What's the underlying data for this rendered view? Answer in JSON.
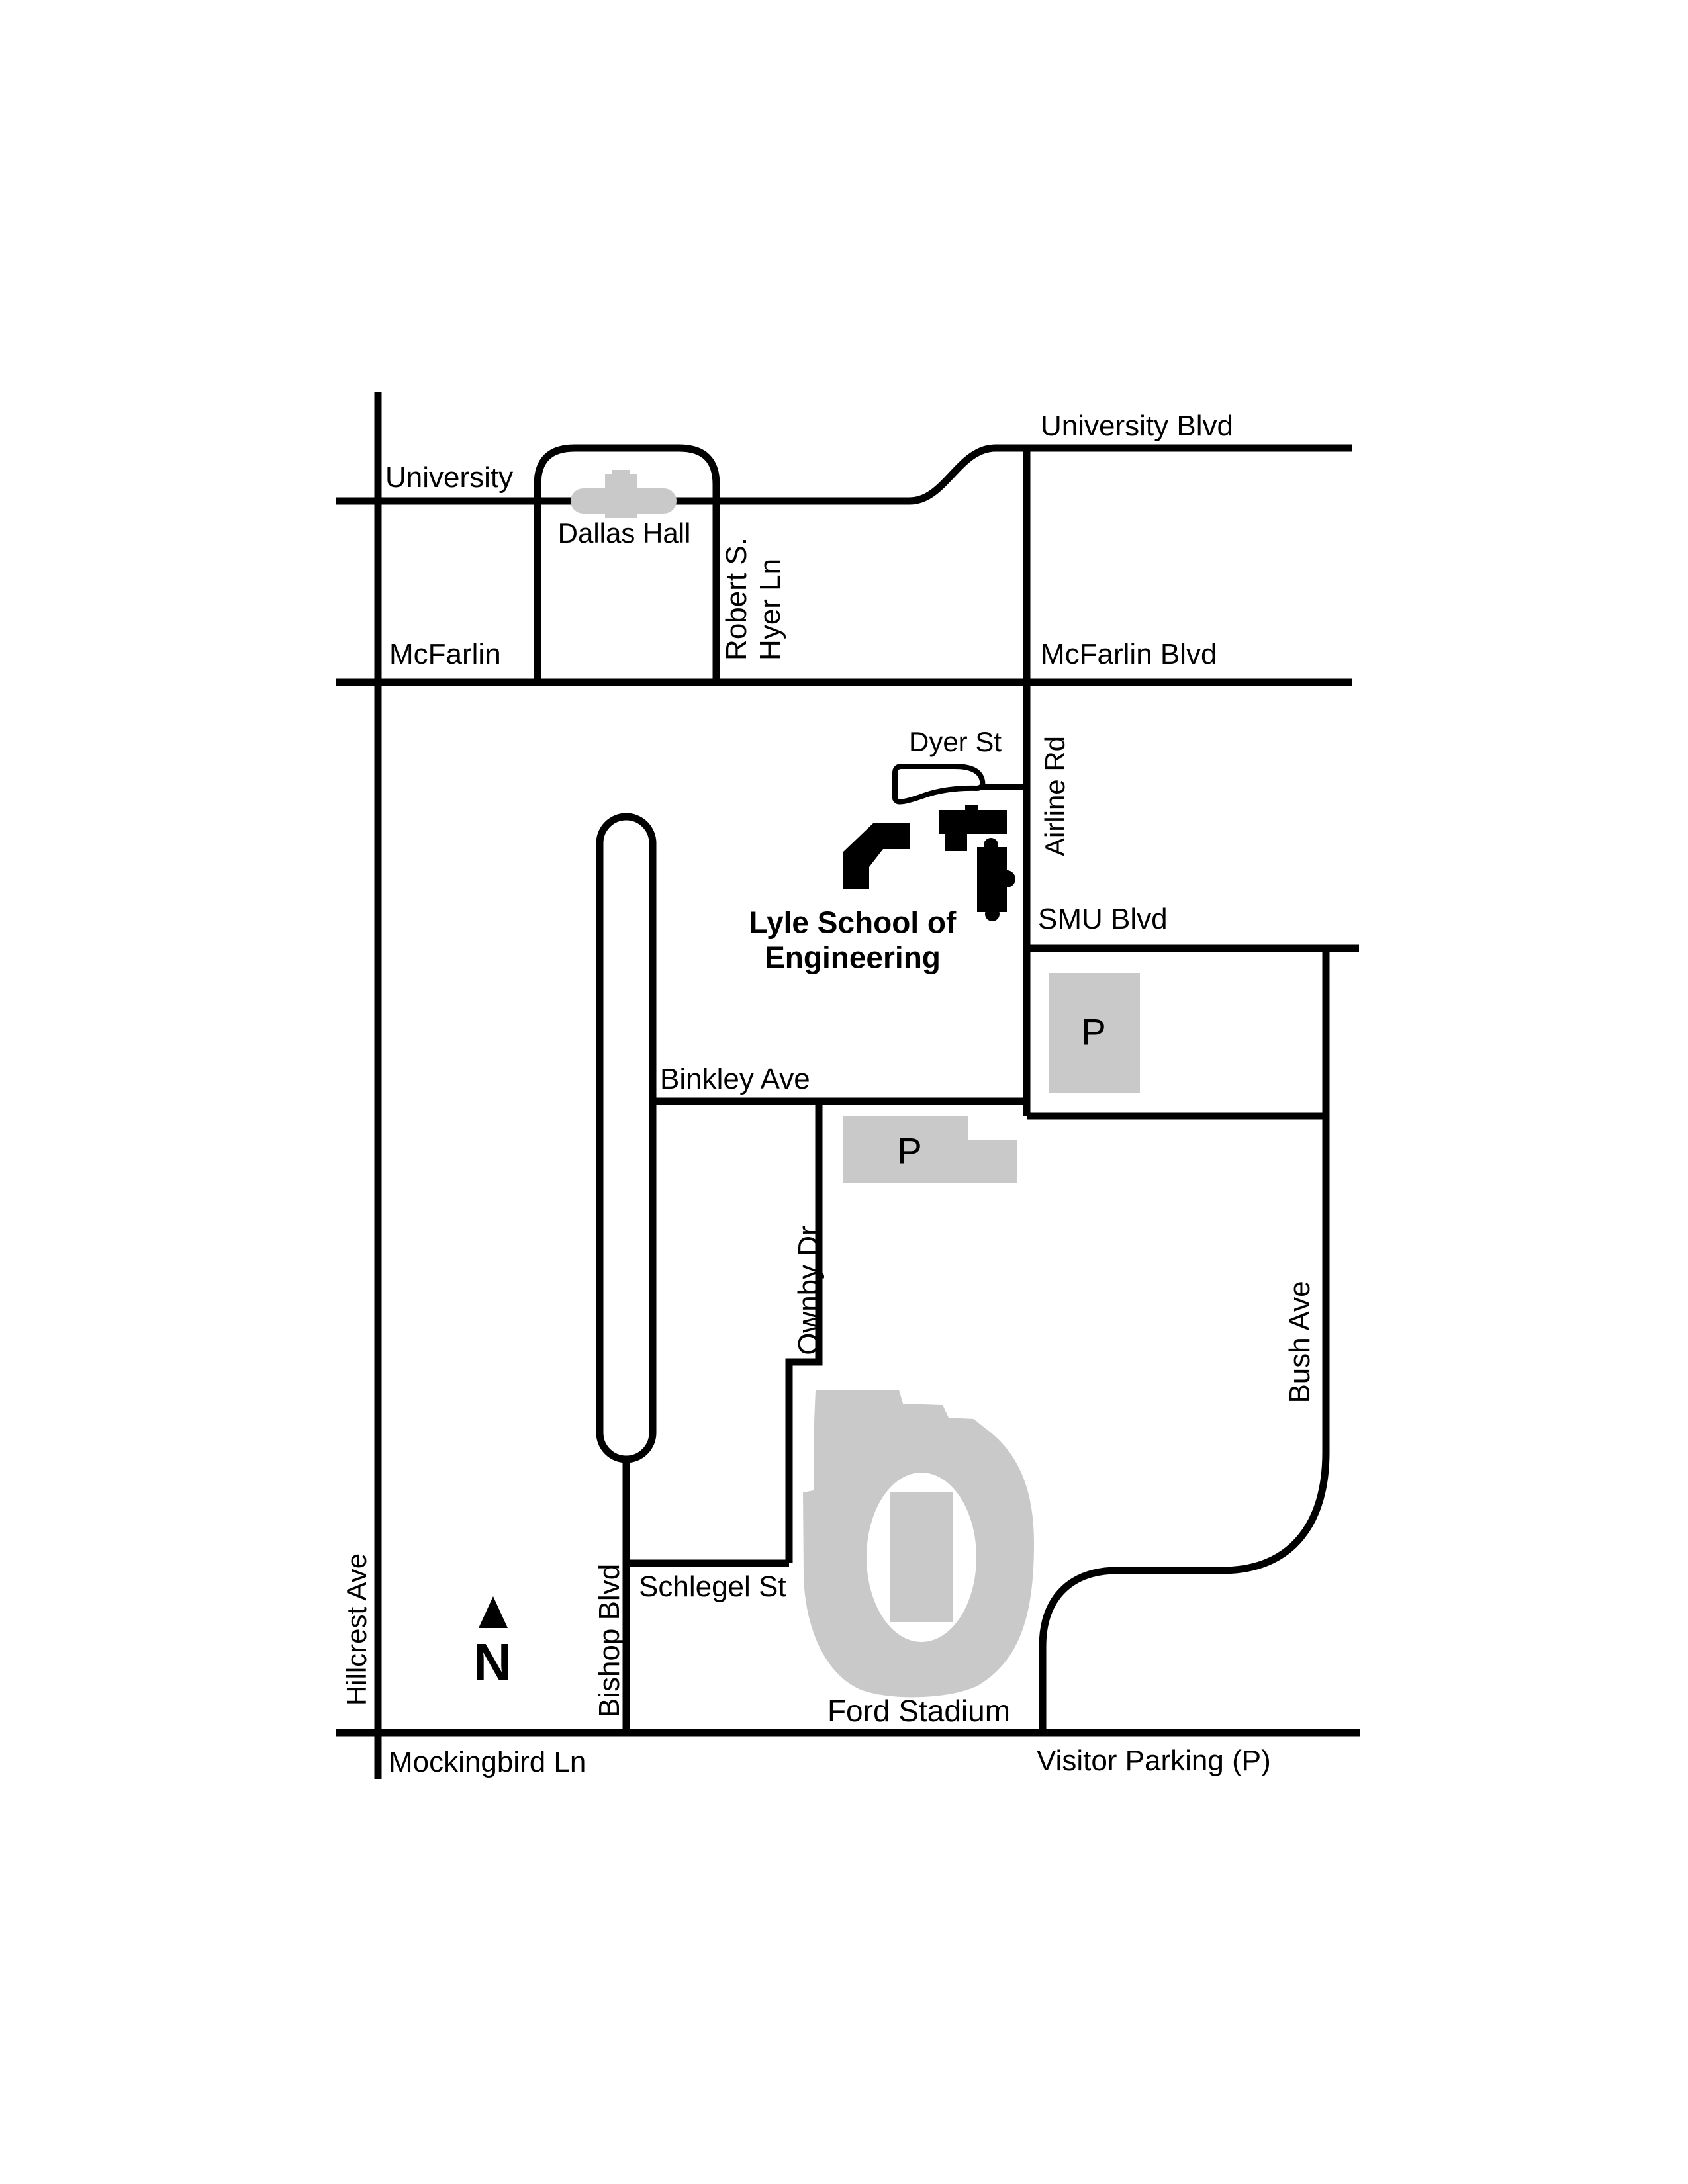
{
  "map": {
    "streets": {
      "university_blvd": "University Blvd",
      "university": "University",
      "mcfarlin": "McFarlin",
      "mcfarlin_blvd": "McFarlin Blvd",
      "robert_s_hyer_line1": "Robert S.",
      "robert_s_hyer_line2": "Hyer Ln",
      "dyer_st": "Dyer St",
      "airline_rd": "Airline Rd",
      "smu_blvd": "SMU Blvd",
      "binkley_ave": "Binkley Ave",
      "ownby_dr": "Ownby Dr",
      "bush_ave": "Bush Ave",
      "schlegel_st": "Schlegel St",
      "bishop_blvd": "Bishop Blvd",
      "hillcrest_ave": "Hillcrest Ave",
      "mockingbird_ln": "Mockingbird Ln"
    },
    "places": {
      "dallas_hall": "Dallas Hall",
      "lyle_line1": "Lyle School of",
      "lyle_line2": "Engineering",
      "ford_stadium": "Ford Stadium",
      "visitor_parking_legend": "Visitor Parking (P)"
    },
    "parking": {
      "p1": "P",
      "p2": "P"
    },
    "compass": {
      "north": "N"
    },
    "colors": {
      "road": "#000000",
      "landmark_gray": "#c9c9c9",
      "campus_building": "#000000",
      "background": "#ffffff"
    }
  }
}
